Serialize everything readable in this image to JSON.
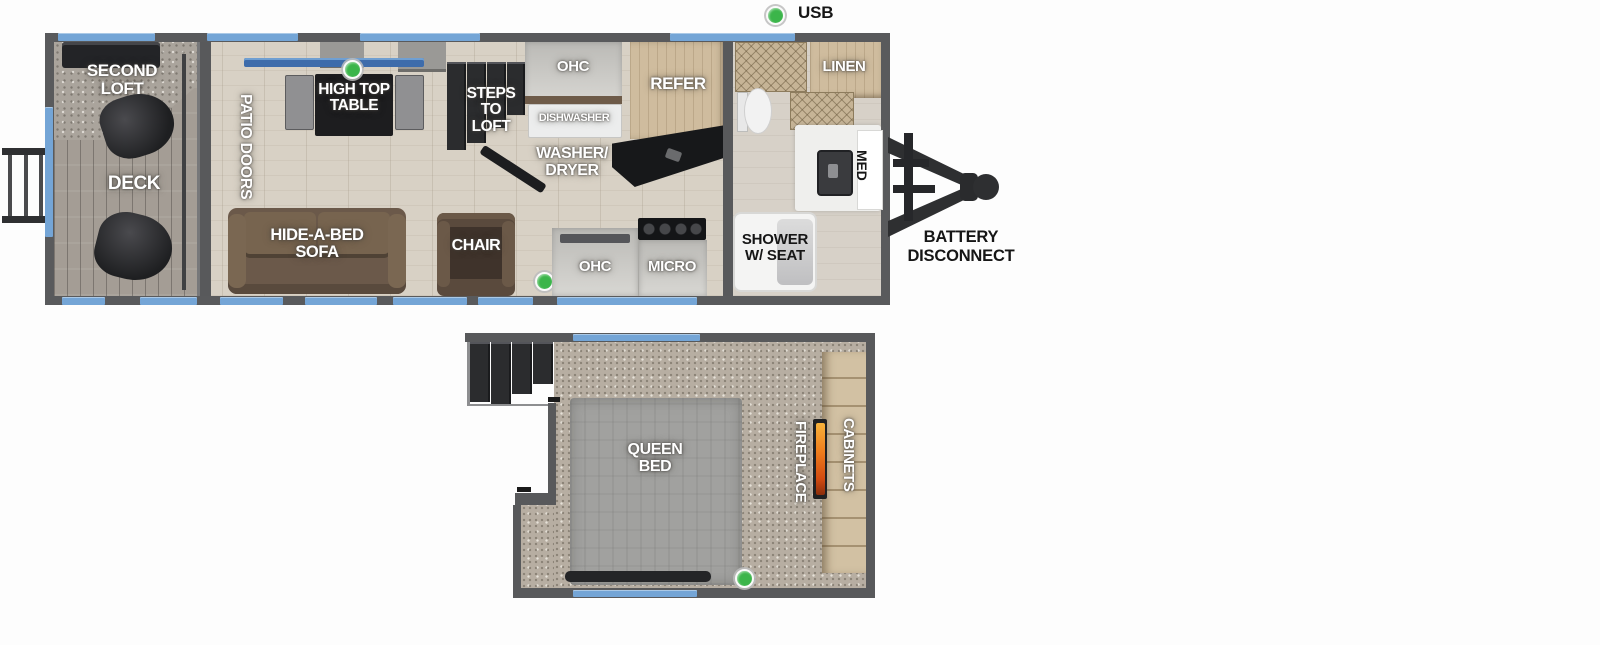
{
  "legend": {
    "usb_label": "USB",
    "usb_color": "#3bb54a"
  },
  "colors": {
    "wall_gray": "#595a5c",
    "window_blue": "#74a5d6",
    "wood_floor": "#d8d1c5",
    "carpet": "#b7aea2",
    "sofa_brown": "#6b594a",
    "flame_orange": "#ef7d1d"
  },
  "main_floor": {
    "areas": {
      "second_loft": "SECOND\nLOFT",
      "deck": "DECK",
      "patio_doors": "PATIO DOORS",
      "high_top_table": "HIGH TOP\nTABLE",
      "steps_to_loft": "STEPS\nTO\nLOFT",
      "ohc_kitchen": "OHC",
      "dishwasher": "DISHWASHER",
      "washer_dryer": "WASHER/\nDRYER",
      "refer": "REFER",
      "linen": "LINEN",
      "med": "MED",
      "hide_a_bed_sofa": "HIDE-A-BED\nSOFA",
      "chair": "CHAIR",
      "ohc_galley": "OHC",
      "micro": "MICRO",
      "shower": "SHOWER\nW/ SEAT"
    },
    "exterior": {
      "battery_disconnect": "BATTERY\nDISCONNECT"
    }
  },
  "loft_floor": {
    "areas": {
      "queen_bed": "QUEEN\nBED",
      "fireplace": "FIREPLACE",
      "cabinets": "CABINETS"
    }
  }
}
